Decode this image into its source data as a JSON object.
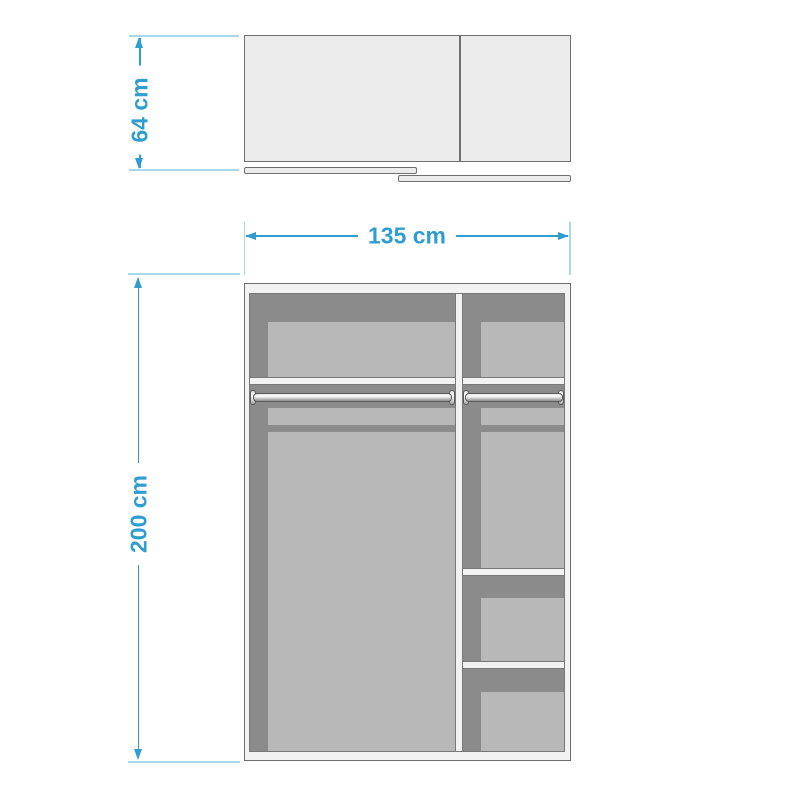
{
  "dimensions": {
    "depth": {
      "label": "64 cm",
      "orientation": "vertical"
    },
    "width": {
      "label": "135 cm",
      "orientation": "horizontal"
    },
    "height": {
      "label": "200 cm",
      "orientation": "vertical"
    }
  },
  "views": {
    "top_view": {
      "parts": [
        "cabinet-outline",
        "door-partition",
        "sliding-door-left",
        "sliding-door-right"
      ]
    },
    "front_view": {
      "left_compartment": [
        "back-panel",
        "shelf",
        "hanging-rod",
        "hanging-space-panel"
      ],
      "right_compartment": [
        "back-panel",
        "shelf",
        "hanging-rod",
        "shelf",
        "shelf",
        "storage-panels"
      ]
    }
  },
  "colors": {
    "dimension_accent": "#2f9dd0",
    "extension_line": "#abd7ea",
    "interior_dark": "#8b8b8b",
    "panel_light": "#b8b8b8",
    "frame_light": "#f2f2f2",
    "top_view_fill": "#ececec",
    "outline": "#6f6f6f",
    "background": "#ffffff"
  }
}
